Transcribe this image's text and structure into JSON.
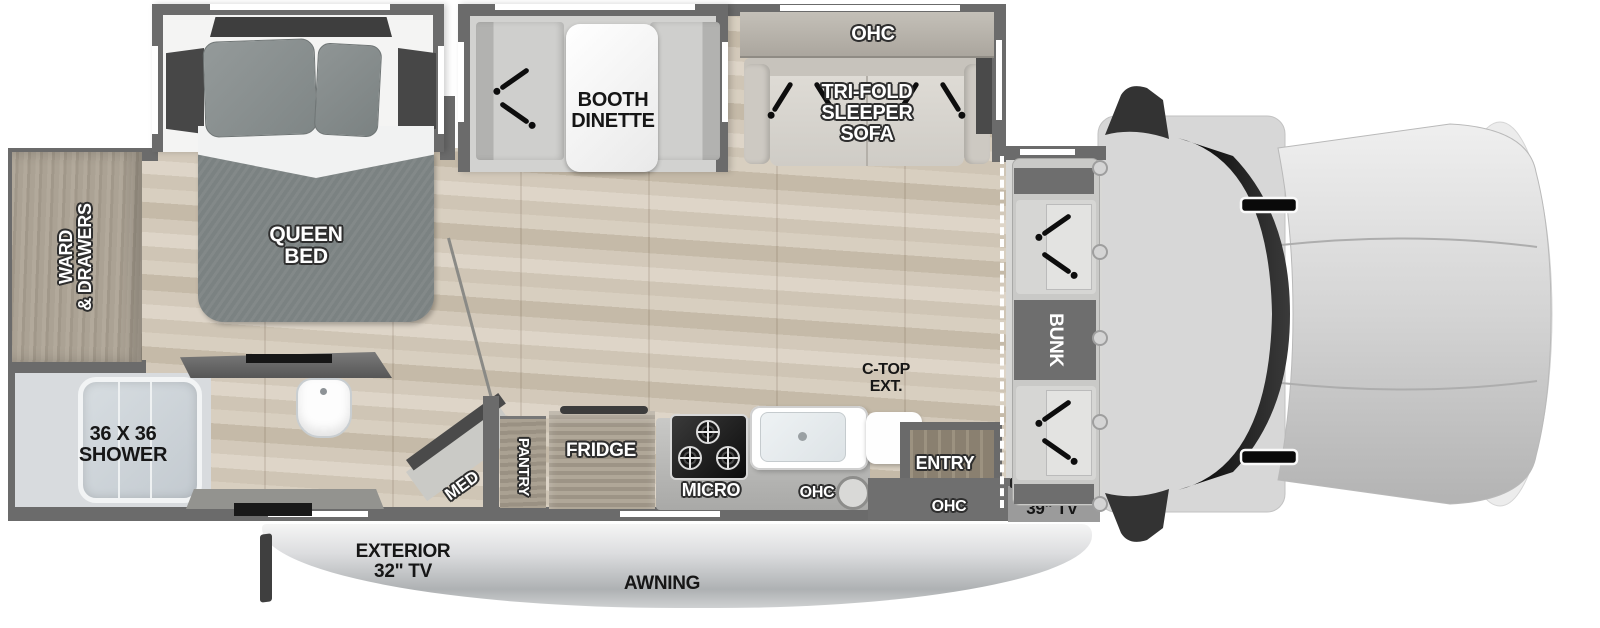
{
  "rooms": {
    "bedroom": {
      "bed_line1": "QUEEN",
      "bed_line2": "BED",
      "wardrobe_line1": "WARD",
      "wardrobe_line2": "& DRAWERS"
    },
    "bathroom": {
      "shower_line1": "36 X 36",
      "shower_line2": "SHOWER",
      "med_cabinet": "MED"
    },
    "living": {
      "dinette_line1": "BOOTH",
      "dinette_line2": "DINETTE",
      "sofa_ohc": "OHC",
      "sofa_line1": "TRI-FOLD",
      "sofa_line2": "SLEEPER",
      "sofa_line3": "SOFA"
    },
    "kitchen": {
      "pantry": "PANTRY",
      "fridge": "FRIDGE",
      "micro": "MICRO",
      "ohc": "OHC",
      "ctop_line1": "C-TOP",
      "ctop_line2": "EXT."
    },
    "entry": {
      "label": "ENTRY",
      "ohc": "OHC"
    },
    "cab": {
      "bunk": "BUNK",
      "tv": "39\" TV"
    },
    "exterior": {
      "tv_line1": "EXTERIOR",
      "tv_line2": "32\" TV",
      "awning": "AWNING"
    }
  },
  "colors": {
    "wall": "#6b6b6b",
    "floor_light": "#d8cfc0",
    "floor_dark": "#c5baa8",
    "bed": "#7b8282",
    "wood_cabinet": "#a89f90",
    "cab_glass": "#141414",
    "hood": "#d9d9d9",
    "awning_bar": "#cdd0d2",
    "seatbelt": "#0d0d0d",
    "label_light": "#ffffff",
    "label_dark": "#161616"
  }
}
